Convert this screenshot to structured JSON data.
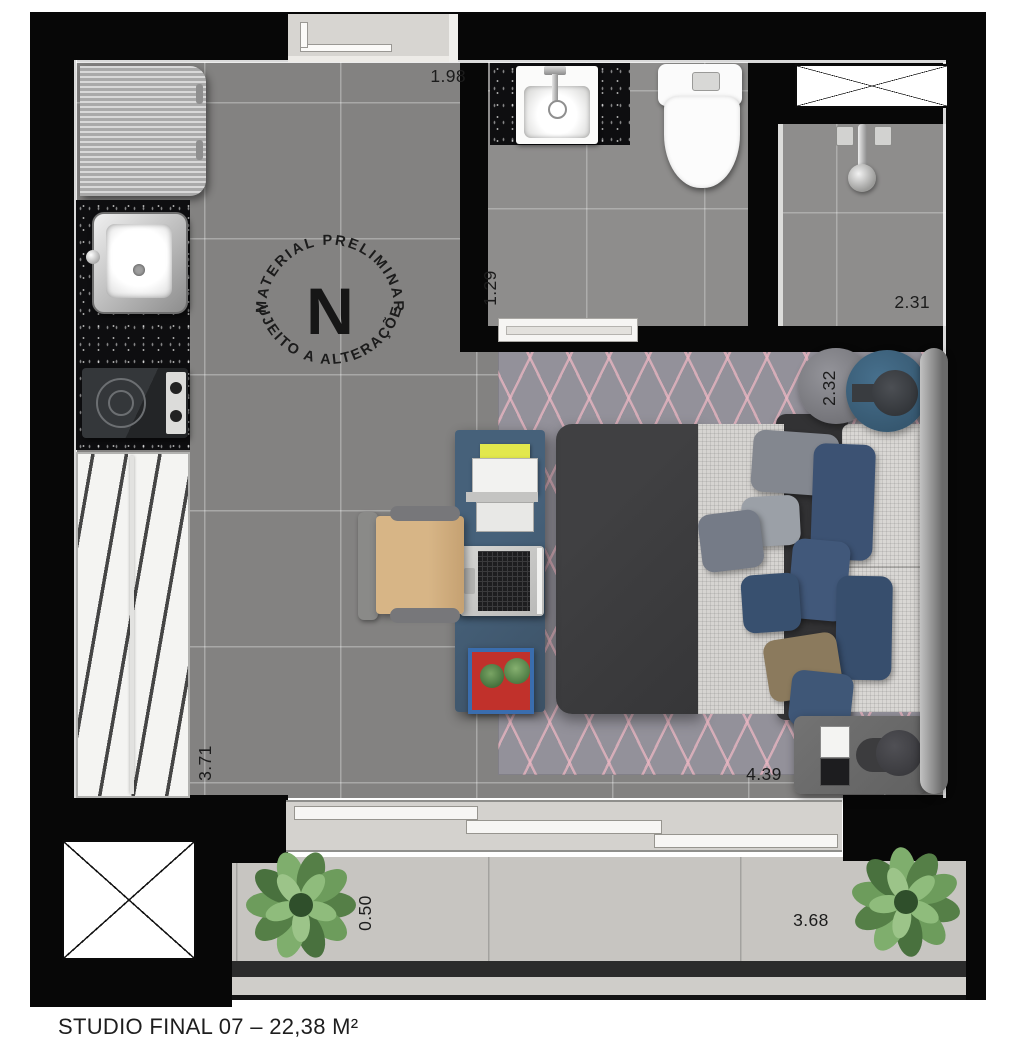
{
  "title": "STUDIO FINAL 07 – 22,38 M²",
  "compass": {
    "letter": "N",
    "arc_top": "• MATERIAL PRELIMINAR •",
    "arc_bottom": "SUJEITO A ALTERAÇÕES"
  },
  "dimensions": {
    "entry": "1.98",
    "bathroom": "1.29",
    "shower": "2.31",
    "bed_zone": "2.32",
    "living": "3.71",
    "bedroom": "4.39",
    "balcony_depth": "0.50",
    "balcony_length": "3.68"
  },
  "palette": {
    "wall": "#070707",
    "floor": "#838281",
    "bath_floor": "#8e8d8c",
    "balcony_floor": "#c7c5c1",
    "rug": "#93919a",
    "rug_accent": "#ebb6c2",
    "desk": "#40566a",
    "pillow_blue": "#3c5273",
    "duvet": "#3a3a3c",
    "plant_green": "#5d8a50",
    "countertop": "#0e0e10"
  }
}
